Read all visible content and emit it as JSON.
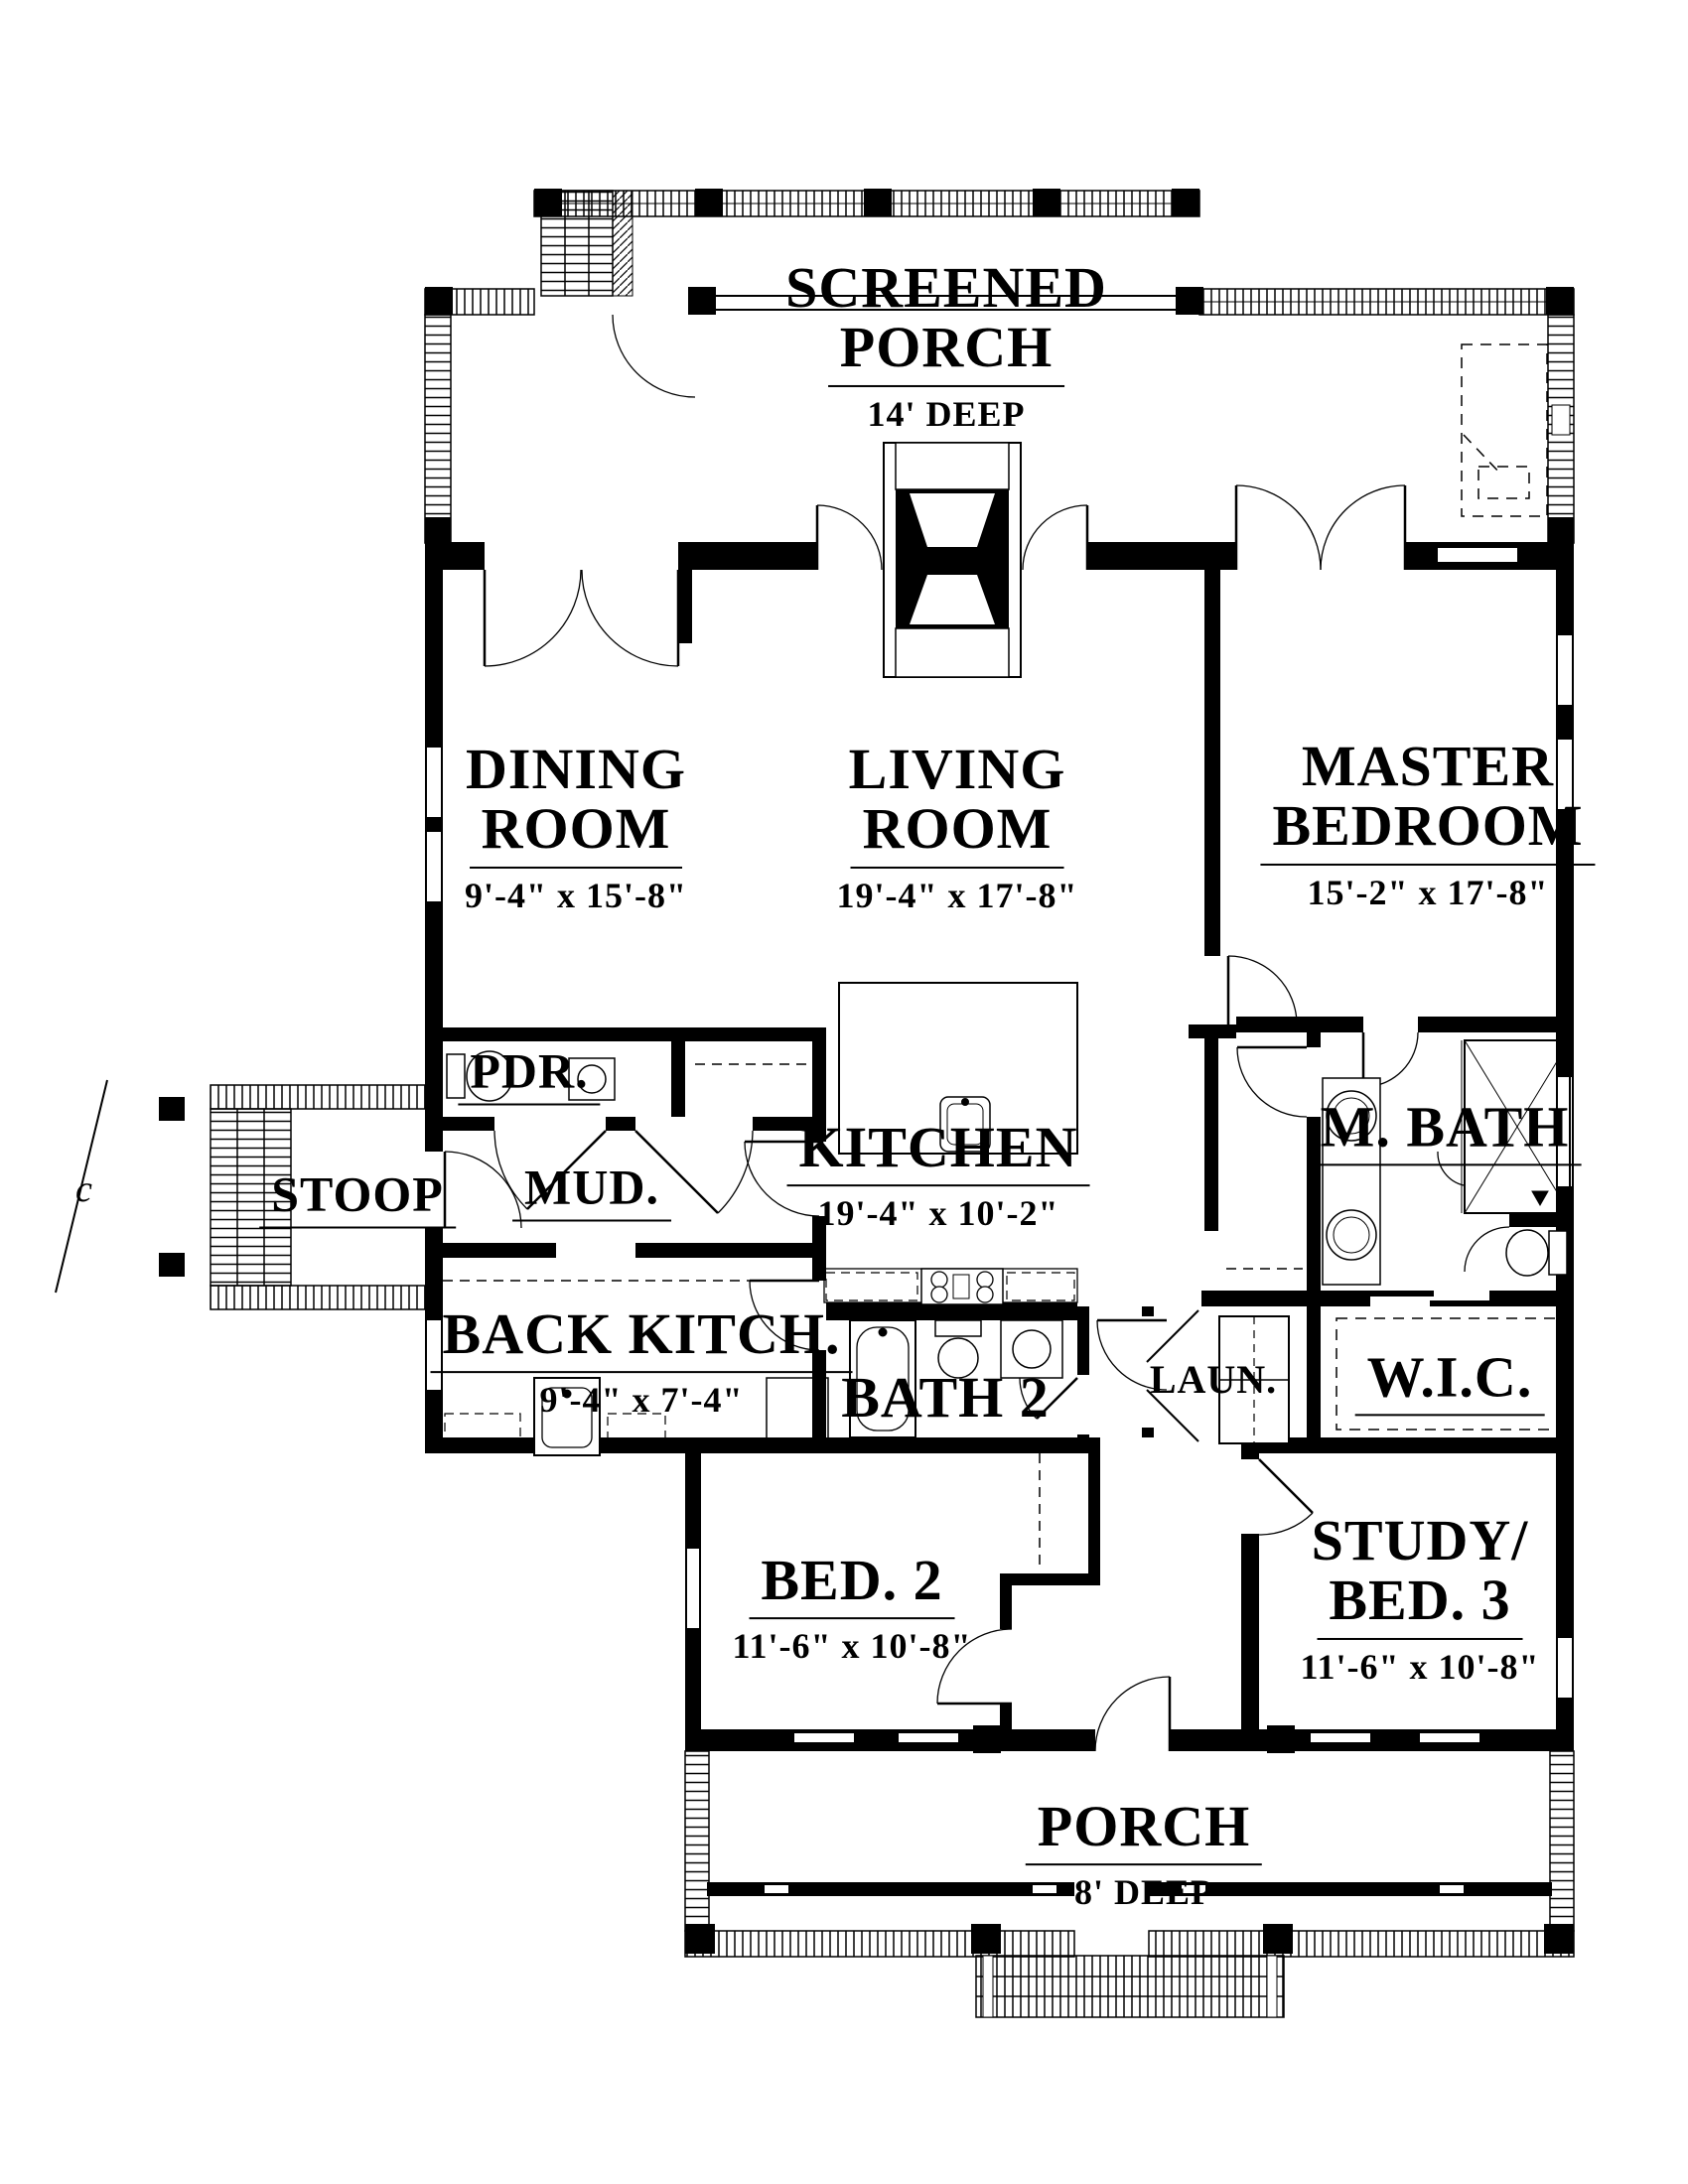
{
  "rooms": {
    "screened_porch": {
      "line1": "SCREENED",
      "line2": "PORCH",
      "dims": "14' DEEP"
    },
    "dining": {
      "line1": "DINING",
      "line2": "ROOM",
      "dims": "9'-4\" x 15'-8\""
    },
    "living": {
      "line1": "LIVING",
      "line2": "ROOM",
      "dims": "19'-4\" x 17'-8\""
    },
    "master": {
      "line1": "MASTER",
      "line2": "BEDROOM",
      "dims": "15'-2\" x 17'-8\""
    },
    "pdr": {
      "line1": "PDR."
    },
    "mud": {
      "line1": "MUD."
    },
    "stoop": {
      "line1": "STOOP"
    },
    "kitchen": {
      "line1": "KITCHEN",
      "dims": "19'-4\" x 10'-2\""
    },
    "master_bath": {
      "line1": "M. BATH"
    },
    "back_kitchen": {
      "line1": "BACK KITCH.",
      "dims": "9'-4\" x 7'-4\""
    },
    "bath2": {
      "line1": "BATH 2"
    },
    "laundry": {
      "line1": "LAUN."
    },
    "wic": {
      "line1": "W.I.C."
    },
    "bed2": {
      "line1": "BED. 2",
      "dims": "11'-6\" x 10'-8\""
    },
    "study": {
      "line1": "STUDY/",
      "line2": "BED. 3",
      "dims": "11'-6\" x 10'-8\""
    },
    "porch": {
      "line1": "PORCH",
      "dims": "8' DEEP"
    }
  },
  "annotations": {
    "centerline": "c"
  },
  "colors": {
    "ink": "#000000",
    "paper": "#ffffff"
  }
}
